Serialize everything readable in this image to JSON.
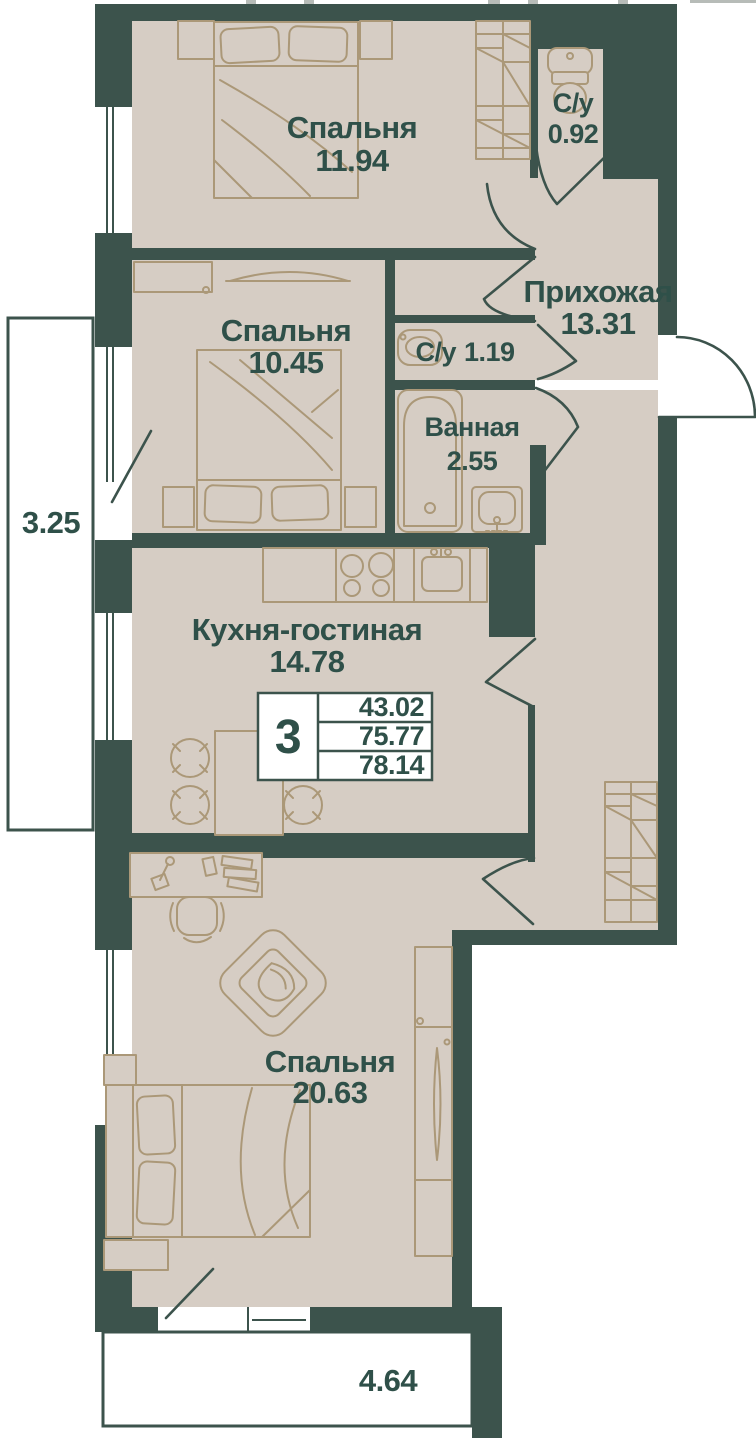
{
  "plan": {
    "rooms": {
      "bedroom1": {
        "name": "Спальня",
        "area": "11.94"
      },
      "bedroom2": {
        "name": "Спальня",
        "area": "10.45"
      },
      "wc_top": {
        "name": "С/у",
        "area": "0.92"
      },
      "hallway": {
        "name": "Прихожая",
        "area": "13.31"
      },
      "wc_small": {
        "name": "С/у",
        "area": "1.19"
      },
      "bathroom": {
        "name": "Ванная",
        "area": "2.55"
      },
      "kitchen_living": {
        "name": "Кухня-гостиная",
        "area": "14.78"
      },
      "bedroom3": {
        "name": "Спальня",
        "area": "20.63"
      }
    },
    "balconies": {
      "left": {
        "area": "3.25"
      },
      "bottom": {
        "area": "4.64"
      }
    },
    "summary": {
      "rooms_count": "3",
      "living_area": "43.02",
      "apartment_area": "75.77",
      "total_area": "78.14"
    },
    "colors": {
      "wall": "#3c534c",
      "floor": "#d6cdc4",
      "furniture_line": "#ab9878",
      "label_text": "#2f5049",
      "background": "#ffffff"
    }
  }
}
